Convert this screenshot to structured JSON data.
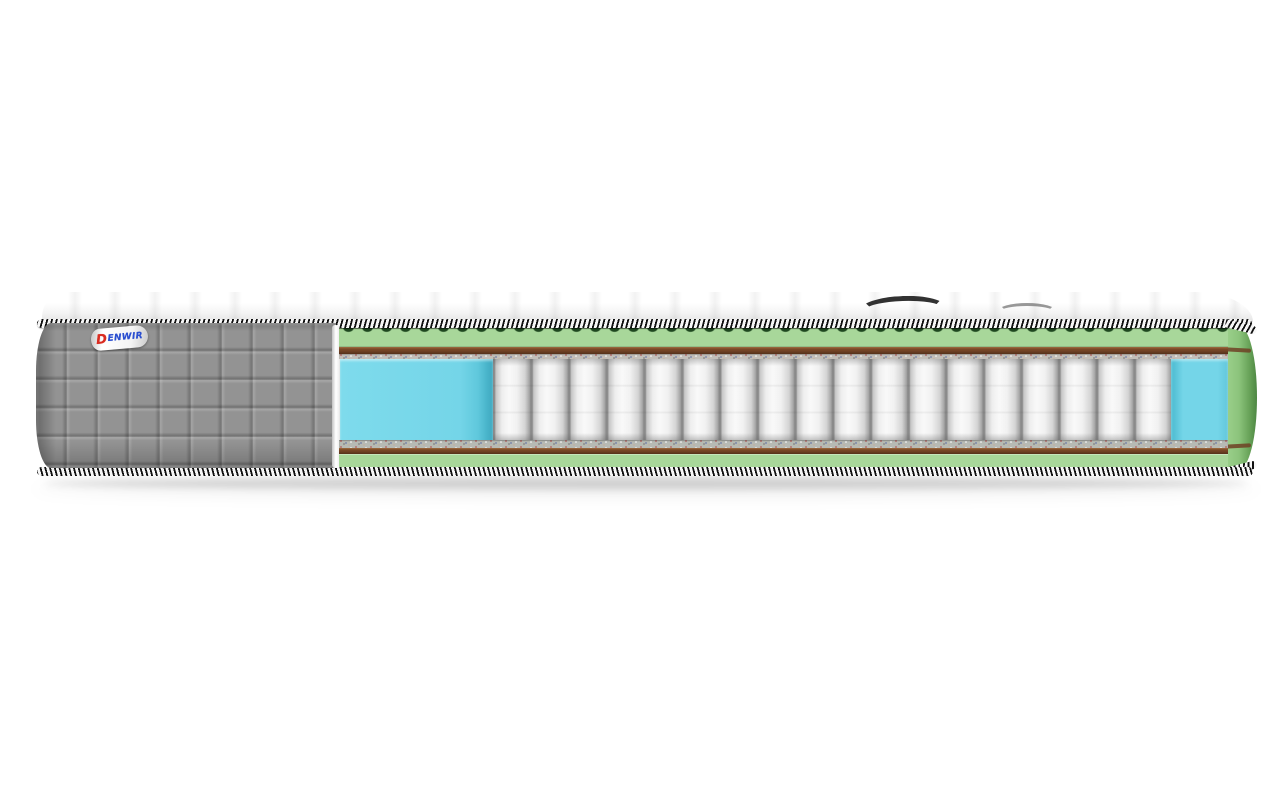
{
  "brand": {
    "d": "D",
    "rest": "ENWIR"
  },
  "palette": {
    "fabric-gray": "#939393",
    "foam-green-light": "#a8d79a",
    "foam-green-dark": "#1e471f",
    "felt-brown": "#6f4124",
    "felt-brown-light": "#96643a",
    "speck-gray": "#c3bfb9",
    "edge-foam-blue": "#74d5e8",
    "edge-foam-blue-dark": "#49b4ca",
    "spring-light": "#f9f9f9",
    "spring-mid": "#d4d4d4",
    "spring-seam": "#8a8a8a",
    "tape-dark": "#101010",
    "tape-light": "#f7f7f7",
    "logo-red": "#d92b20",
    "logo-blue": "#2b4fd0",
    "shadow": "rgba(0,0,0,0.16)"
  }
}
